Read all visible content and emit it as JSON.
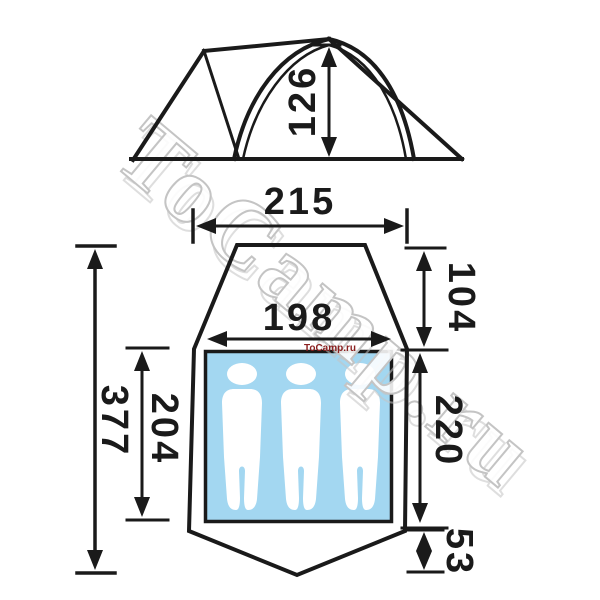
{
  "diagram_title": "tent-dimension-drawing",
  "side_view": {
    "height": "126"
  },
  "floor_plan": {
    "outer_width": "215",
    "inner_width": "198",
    "vestibule_depth": "104",
    "total_length": "377",
    "inner_length": "204",
    "sleeping_length": "220",
    "rear_depth": "53",
    "sleeper_count": 3
  },
  "watermark": {
    "large_text": "ToCamp.ru",
    "small_text": "ToCamp.ru"
  },
  "colors": {
    "line": "#1a1a1a",
    "floor_fill": "#a3d7f1",
    "silhouette": "#ffffff",
    "watermark_small": "#8b2020",
    "watermark_outline": "#c4c4c4",
    "watermark_fill": "rgba(255,255,255,0.88)"
  }
}
